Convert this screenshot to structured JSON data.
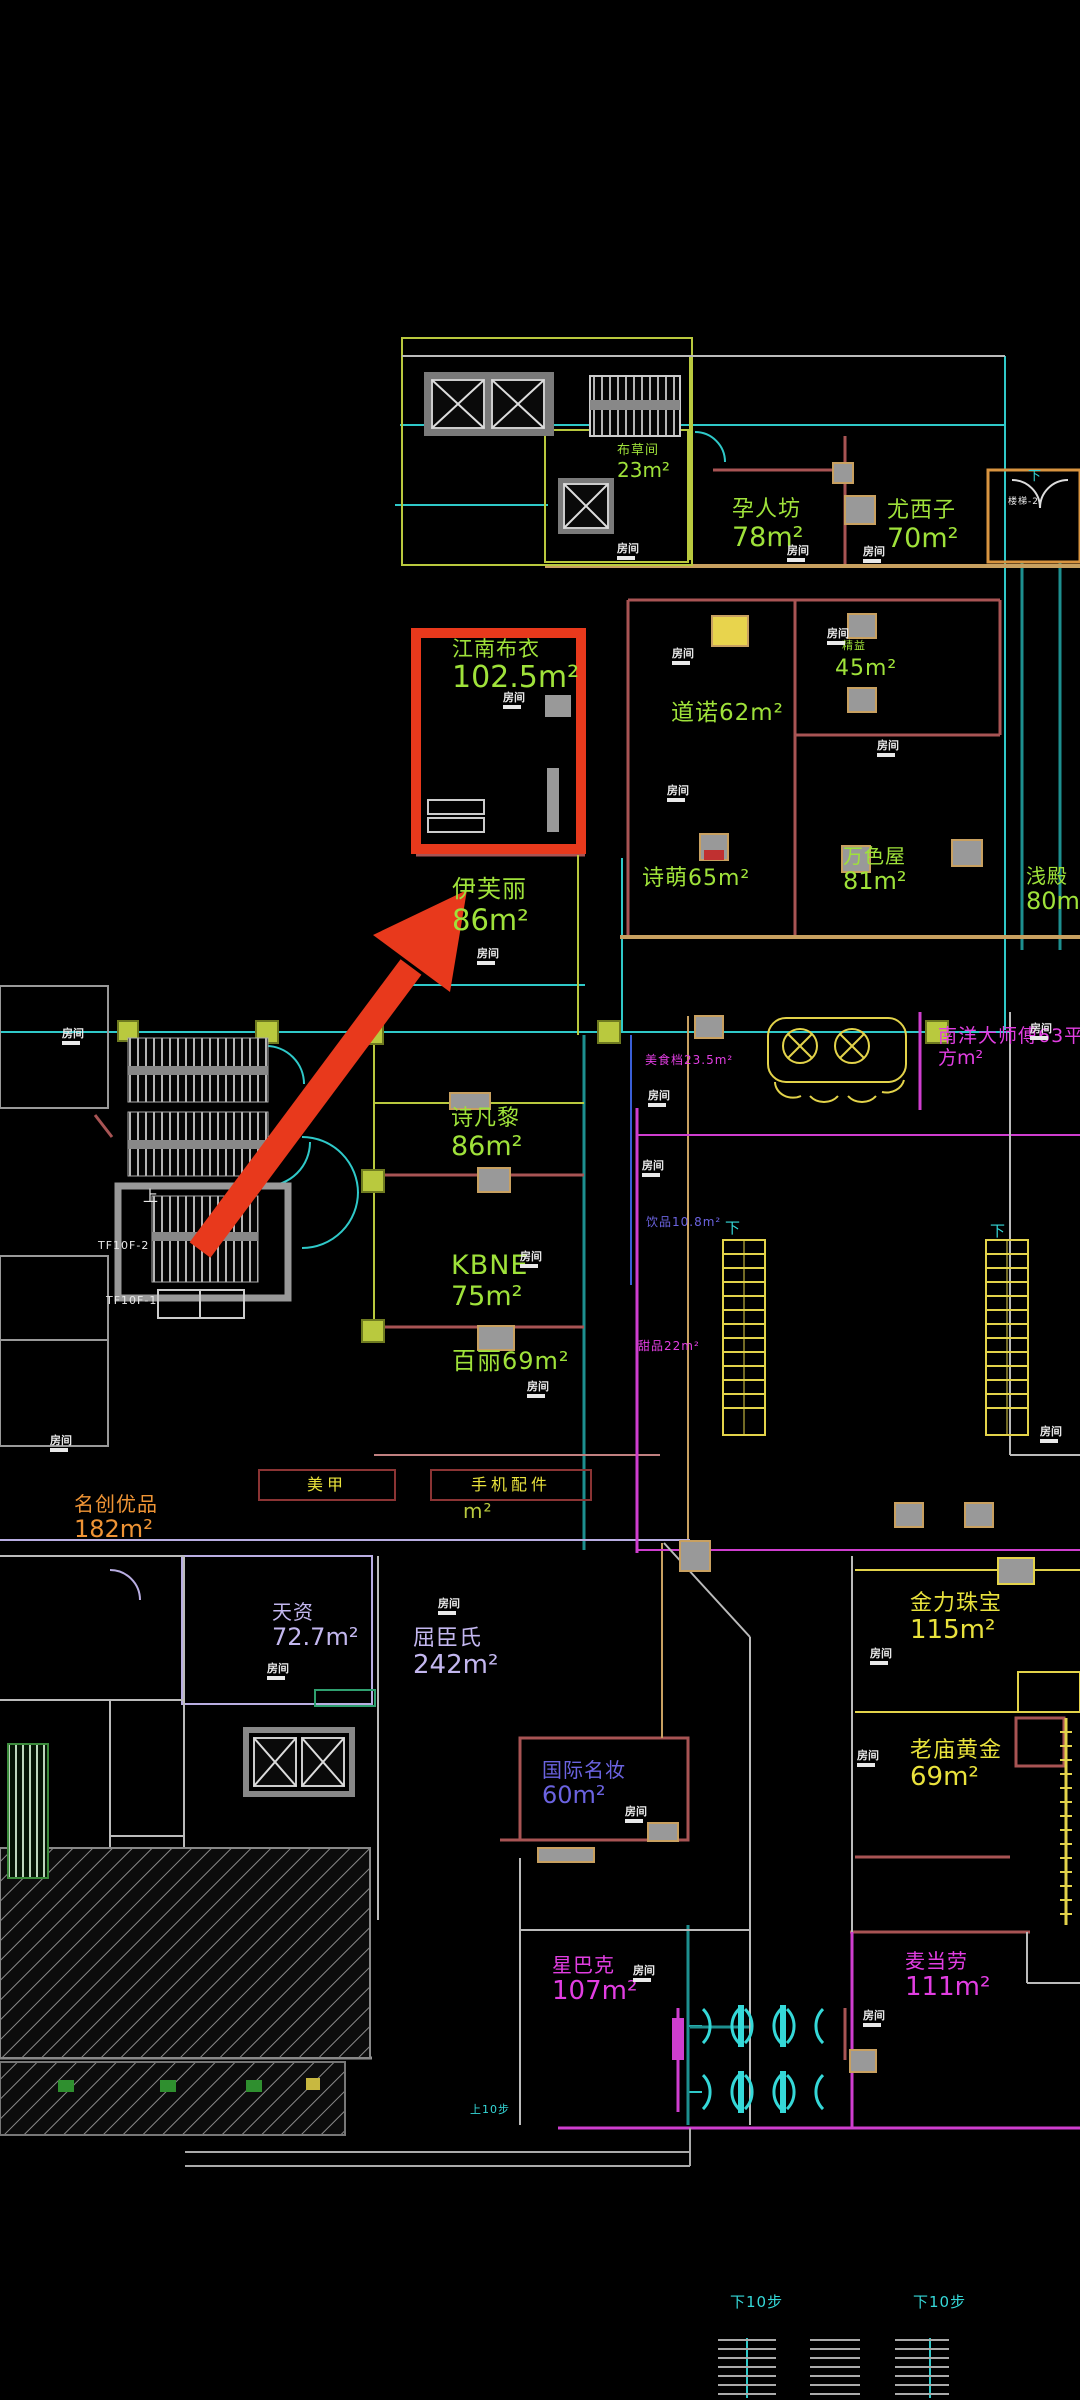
{
  "meta": {
    "kind": "cad-floorplan-screenshot",
    "floor": "mall-retail-level",
    "background": "#000000"
  },
  "palette": {
    "highlight": "#e8391c",
    "green": "#9fe23a",
    "olive": "#b9c93e",
    "yellow": "#e9e23c",
    "orange": "#ef9435",
    "lavender": "#c3b7ef",
    "blue": "#6b63e0",
    "magenta": "#e23ee2",
    "cyan": "#35d8d8",
    "white": "#e9e9e9"
  },
  "highlight": {
    "shop": "江南布衣",
    "area": "102.5m²",
    "note": "red box + red arrow annotation"
  },
  "tag_text": "房间",
  "labels": [
    {
      "id": "jnby",
      "name": "江南布衣",
      "area": "102.5m²",
      "color": "#9fe23a",
      "x": 452,
      "y": 637,
      "ns": 21,
      "as": 30
    },
    {
      "id": "eifini",
      "name": "伊芙丽",
      "area": "86m²",
      "color": "#9fe23a",
      "x": 452,
      "y": 876,
      "ns": 24,
      "as": 29
    },
    {
      "id": "yrf",
      "name": "孕人坊",
      "area": "78m²",
      "color": "#9fe23a",
      "x": 732,
      "y": 497,
      "ns": 22,
      "as": 27
    },
    {
      "id": "yxz",
      "name": "尤西子",
      "area": "70m²",
      "color": "#9fe23a",
      "x": 887,
      "y": 498,
      "ns": 22,
      "as": 27
    },
    {
      "id": "bcj",
      "name": "布草间",
      "area": "23m²",
      "color": "#9fe23a",
      "x": 617,
      "y": 444,
      "ns": 13,
      "as": 20
    },
    {
      "id": "dn",
      "name": "道诺62m²",
      "color": "#9fe23a",
      "x": 671,
      "y": 700,
      "ns": 23
    },
    {
      "id": "jy",
      "name": "精益",
      "color": "#9fe23a",
      "x": 842,
      "y": 640,
      "ns": 11
    },
    {
      "id": "r45",
      "name": "45m²",
      "color": "#9fe23a",
      "x": 835,
      "y": 656,
      "ns": 22
    },
    {
      "id": "sm",
      "name": "诗萌65m²",
      "color": "#9fe23a",
      "x": 642,
      "y": 866,
      "ns": 22
    },
    {
      "id": "wsw",
      "name": "万色屋",
      "area": "81m²",
      "color": "#9fe23a",
      "x": 843,
      "y": 845,
      "ns": 20,
      "as": 24
    },
    {
      "id": "qd",
      "name": "浅殿",
      "area": "80m²",
      "color": "#9fe23a",
      "x": 1026,
      "y": 865,
      "ns": 20,
      "as": 24
    },
    {
      "id": "sfl",
      "name": "诗凡黎",
      "area": "86m²",
      "color": "#9fe23a",
      "x": 451,
      "y": 1106,
      "ns": 22,
      "as": 27
    },
    {
      "id": "kbne",
      "name": "KBNE",
      "area": "75m²",
      "color": "#9fe23a",
      "x": 451,
      "y": 1250,
      "ns": 27,
      "as": 27
    },
    {
      "id": "bl",
      "name": "百丽69m²",
      "color": "#9fe23a",
      "x": 452,
      "y": 1348,
      "ns": 24
    },
    {
      "id": "mj",
      "name": "美甲",
      "color": "#e9e23c",
      "x": 258,
      "y": 1469,
      "ns": 16,
      "box": [
        134,
        28
      ]
    },
    {
      "id": "sjpj",
      "name": "手机配件",
      "color": "#e9e23c",
      "x": 430,
      "y": 1469,
      "ns": 16,
      "box": [
        158,
        28
      ]
    },
    {
      "id": "m2",
      "name": "m²",
      "color": "#b9c93e",
      "x": 463,
      "y": 1500,
      "ns": 20
    },
    {
      "id": "mcyp",
      "name": "名创优品",
      "area": "182m²",
      "color": "#ef9435",
      "x": 74,
      "y": 1493,
      "ns": 20,
      "as": 24
    },
    {
      "id": "tz",
      "name": "天资",
      "area": "72.7m²",
      "color": "#c3b7ef",
      "x": 272,
      "y": 1601,
      "ns": 20,
      "as": 24
    },
    {
      "id": "qcs",
      "name": "屈臣氏",
      "area": "242m²",
      "color": "#c3b7ef",
      "x": 413,
      "y": 1626,
      "ns": 22,
      "as": 26
    },
    {
      "id": "gjmz",
      "name": "国际名妆",
      "area": "60m²",
      "color": "#6b63e0",
      "x": 542,
      "y": 1759,
      "ns": 20,
      "as": 24
    },
    {
      "id": "sbk",
      "name": "星巴克",
      "area": "107m²",
      "color": "#e23ee2",
      "x": 552,
      "y": 1954,
      "ns": 20,
      "as": 26
    },
    {
      "id": "jlzb",
      "name": "金力珠宝",
      "area": "115m²",
      "color": "#e9e23c",
      "x": 910,
      "y": 1591,
      "ns": 22,
      "as": 26
    },
    {
      "id": "lmhj",
      "name": "老庙黄金",
      "area": "69m²",
      "color": "#e9e23c",
      "x": 910,
      "y": 1738,
      "ns": 22,
      "as": 26
    },
    {
      "id": "mdl",
      "name": "麦当劳",
      "area": "111m²",
      "color": "#e23ee2",
      "x": 905,
      "y": 1950,
      "ns": 20,
      "as": 26
    },
    {
      "id": "nydsf",
      "name": "南洋大师傅63平",
      "area": "方m²",
      "color": "#e23ee2",
      "x": 938,
      "y": 1026,
      "ns": 19,
      "as": 19
    },
    {
      "id": "msd",
      "name": "美食档23.5m²",
      "color": "#e23ee2",
      "x": 645,
      "y": 1054,
      "ns": 12
    },
    {
      "id": "yp",
      "name": "饮品10.8m²",
      "color": "#6b63e0",
      "x": 646,
      "y": 1216,
      "ns": 12
    },
    {
      "id": "tp",
      "name": "甜品22m²",
      "color": "#e23ee2",
      "x": 638,
      "y": 1340,
      "ns": 12
    },
    {
      "id": "tf2",
      "name": "TF10F-2",
      "color": "#e9e9e9",
      "x": 98,
      "y": 1240,
      "ns": 11
    },
    {
      "id": "tf1",
      "name": "TF10F-1",
      "color": "#e9e9e9",
      "x": 106,
      "y": 1295,
      "ns": 11
    },
    {
      "id": "lt2",
      "name": "楼梯-2",
      "color": "#e9e9e9",
      "x": 1008,
      "y": 497,
      "ns": 9
    },
    {
      "id": "up1",
      "name": "上",
      "color": "#e9e9e9",
      "x": 143,
      "y": 1188,
      "ns": 15
    },
    {
      "id": "down0",
      "name": "下",
      "color": "#35d8d8",
      "x": 1028,
      "y": 470,
      "ns": 13
    },
    {
      "id": "down1",
      "name": "下",
      "color": "#35d8d8",
      "x": 725,
      "y": 1220,
      "ns": 15
    },
    {
      "id": "down2",
      "name": "下",
      "color": "#35d8d8",
      "x": 990,
      "y": 1223,
      "ns": 15
    },
    {
      "id": "s10",
      "name": "上10步",
      "color": "#35d8d8",
      "x": 470,
      "y": 2104,
      "ns": 11
    },
    {
      "id": "x10a",
      "name": "下10步",
      "color": "#35d8d8",
      "x": 730,
      "y": 2294,
      "ns": 15
    },
    {
      "id": "x10b",
      "name": "下10步",
      "color": "#35d8d8",
      "x": 913,
      "y": 2294,
      "ns": 15
    }
  ],
  "room_tags": [
    [
      617,
      543
    ],
    [
      787,
      545
    ],
    [
      863,
      546
    ],
    [
      672,
      648
    ],
    [
      827,
      628
    ],
    [
      877,
      740
    ],
    [
      503,
      692
    ],
    [
      667,
      785
    ],
    [
      477,
      948
    ],
    [
      648,
      1090
    ],
    [
      642,
      1160
    ],
    [
      520,
      1251
    ],
    [
      527,
      1381
    ],
    [
      438,
      1598
    ],
    [
      267,
      1663
    ],
    [
      625,
      1806
    ],
    [
      633,
      1965
    ],
    [
      870,
      1648
    ],
    [
      857,
      1750
    ],
    [
      863,
      2010
    ],
    [
      1030,
      1023
    ],
    [
      1040,
      1426
    ],
    [
      50,
      1435
    ],
    [
      62,
      1028
    ]
  ]
}
